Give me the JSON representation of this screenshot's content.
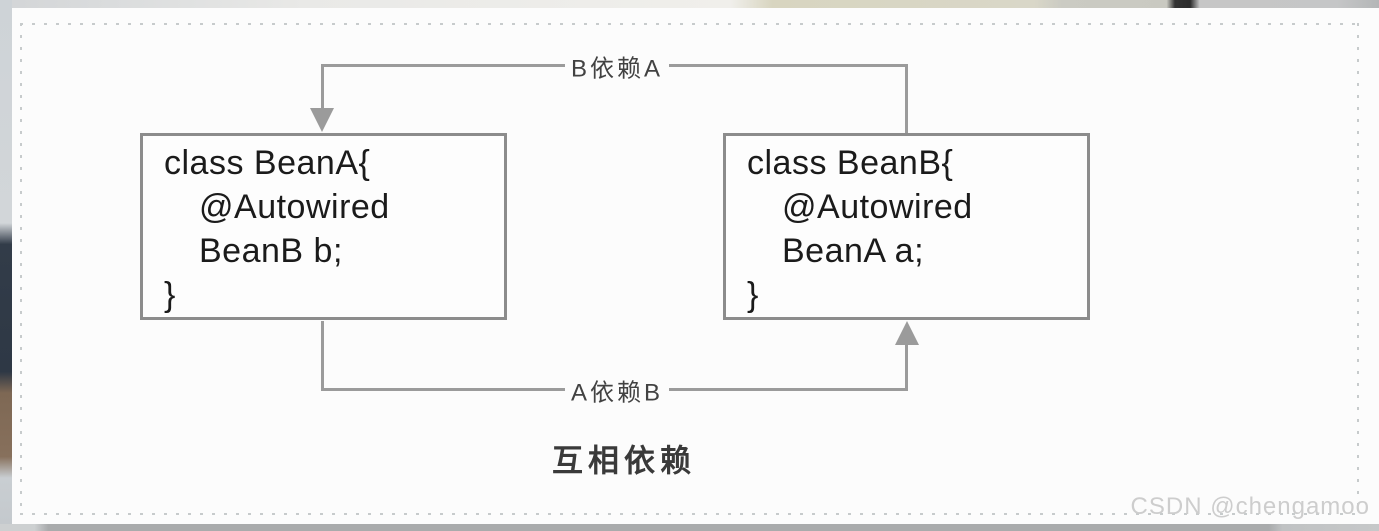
{
  "diagram": {
    "box_a": {
      "lines": [
        "class BeanA{",
        "@Autowired",
        "BeanB b;",
        "}"
      ]
    },
    "box_b": {
      "lines": [
        "class BeanB{",
        "@Autowired",
        "BeanA a;",
        "}"
      ]
    },
    "arrow_b_depends_a": "B依赖A",
    "arrow_a_depends_b": "A依赖B",
    "caption": "互相依赖"
  },
  "watermark": "CSDN @chengamoo",
  "colors": {
    "connector": "#9b9b9b",
    "box_border": "#8c8c8c",
    "code_text": "#1b1b1b",
    "label_text": "#424242",
    "caption_text": "#3a3a3a",
    "watermark_text": "#cdcdcd",
    "panel_bg": "#fcfcfc",
    "dash": "#c7cbcc"
  }
}
